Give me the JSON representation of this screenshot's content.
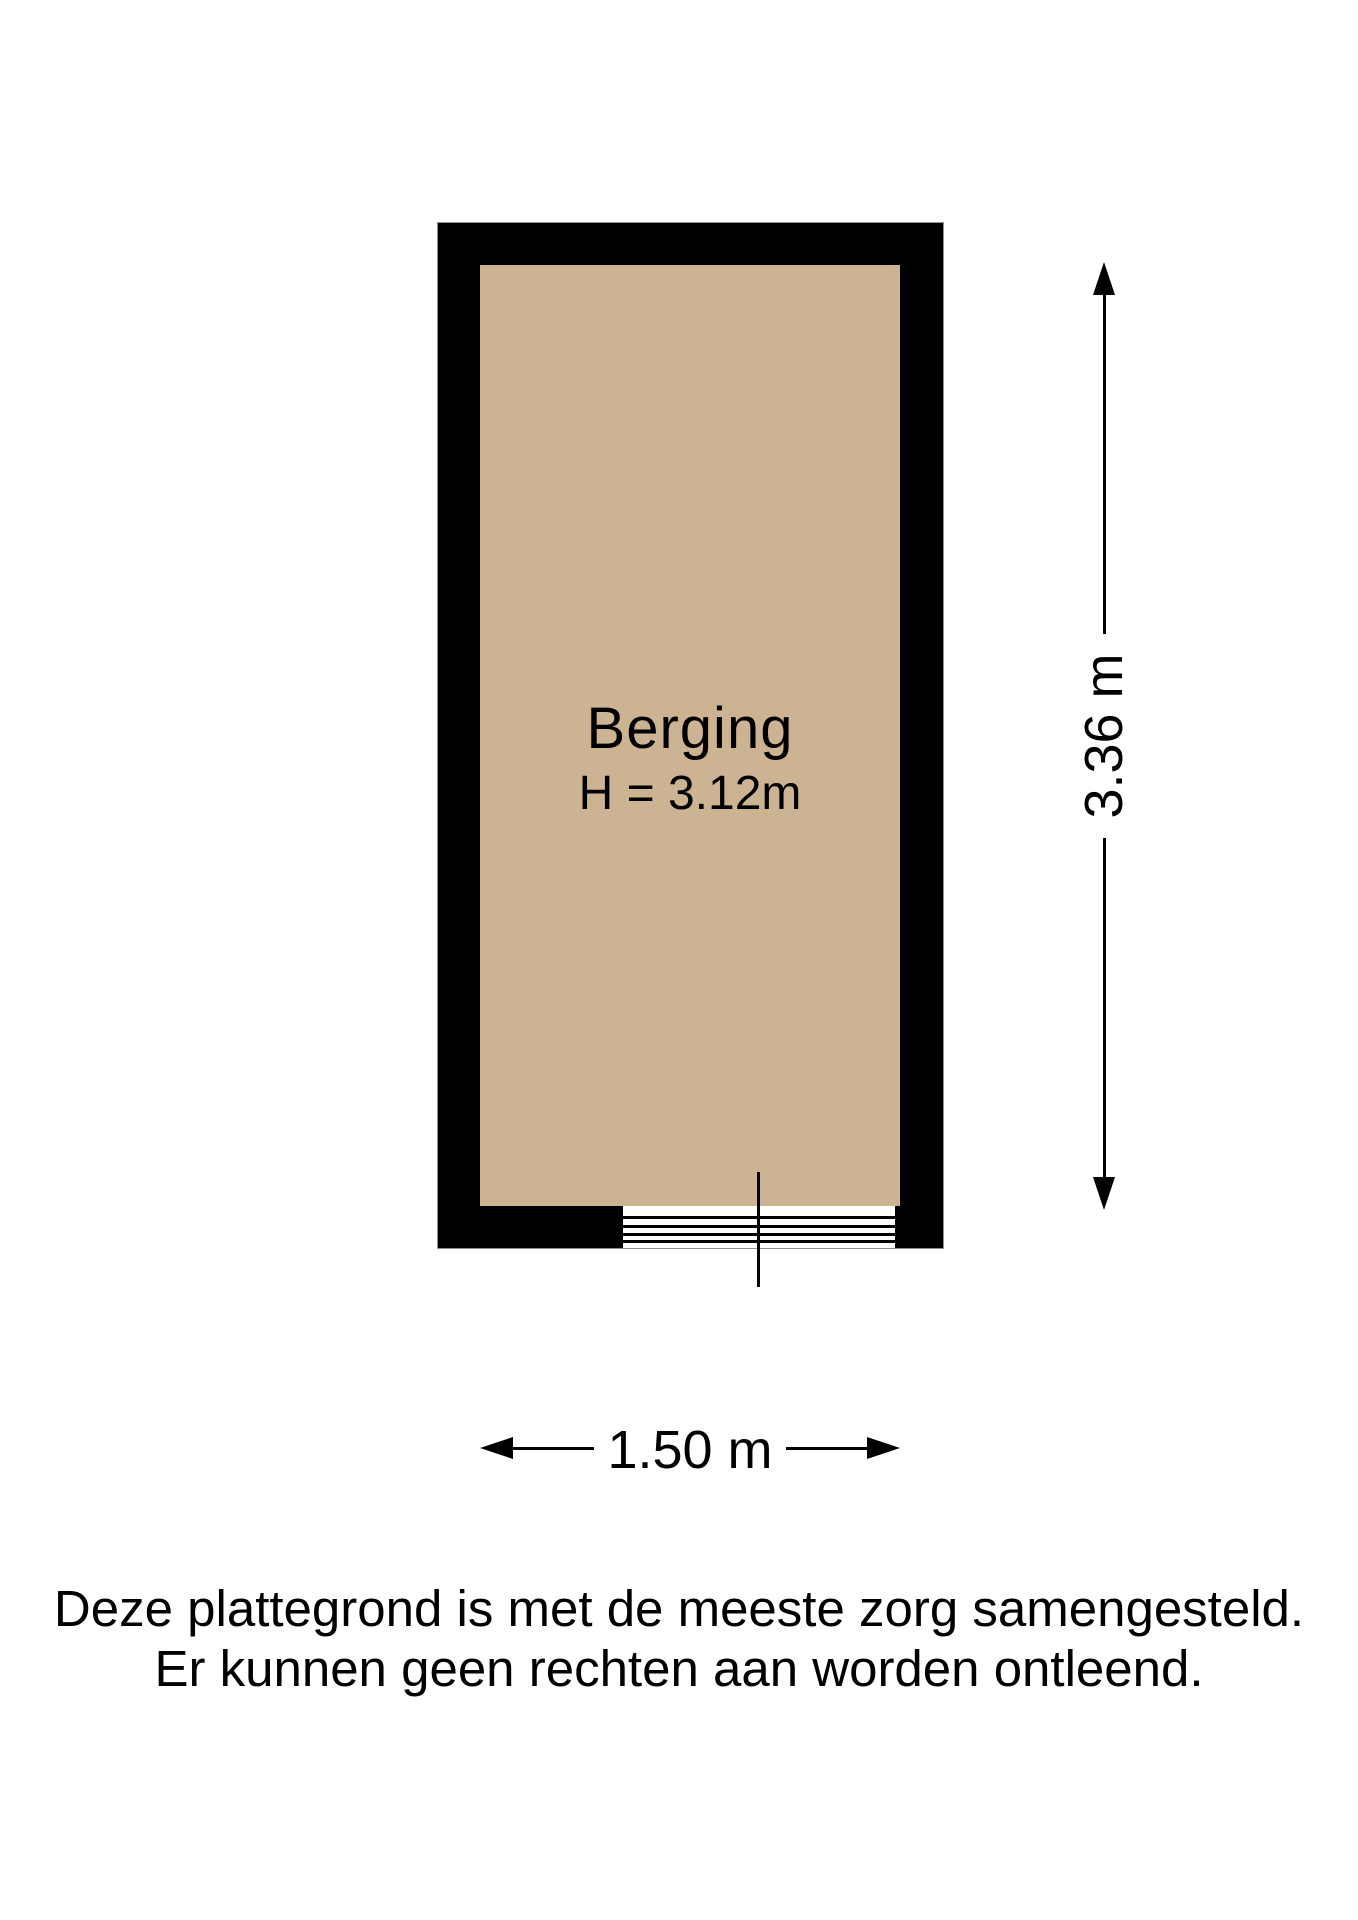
{
  "floorplan": {
    "room": {
      "name": "Berging",
      "ceiling_height": "H = 3.12m"
    },
    "dimensions": {
      "width": "1.50 m",
      "height": "3.36 m"
    },
    "disclaimer": {
      "line1": "Deze plattegrond is met de meeste zorg samengesteld.",
      "line2": "Er kunnen geen rechten aan worden ontleend."
    },
    "colors": {
      "wall": "#000000",
      "floor": "#ccb492",
      "background": "#ffffff"
    }
  }
}
